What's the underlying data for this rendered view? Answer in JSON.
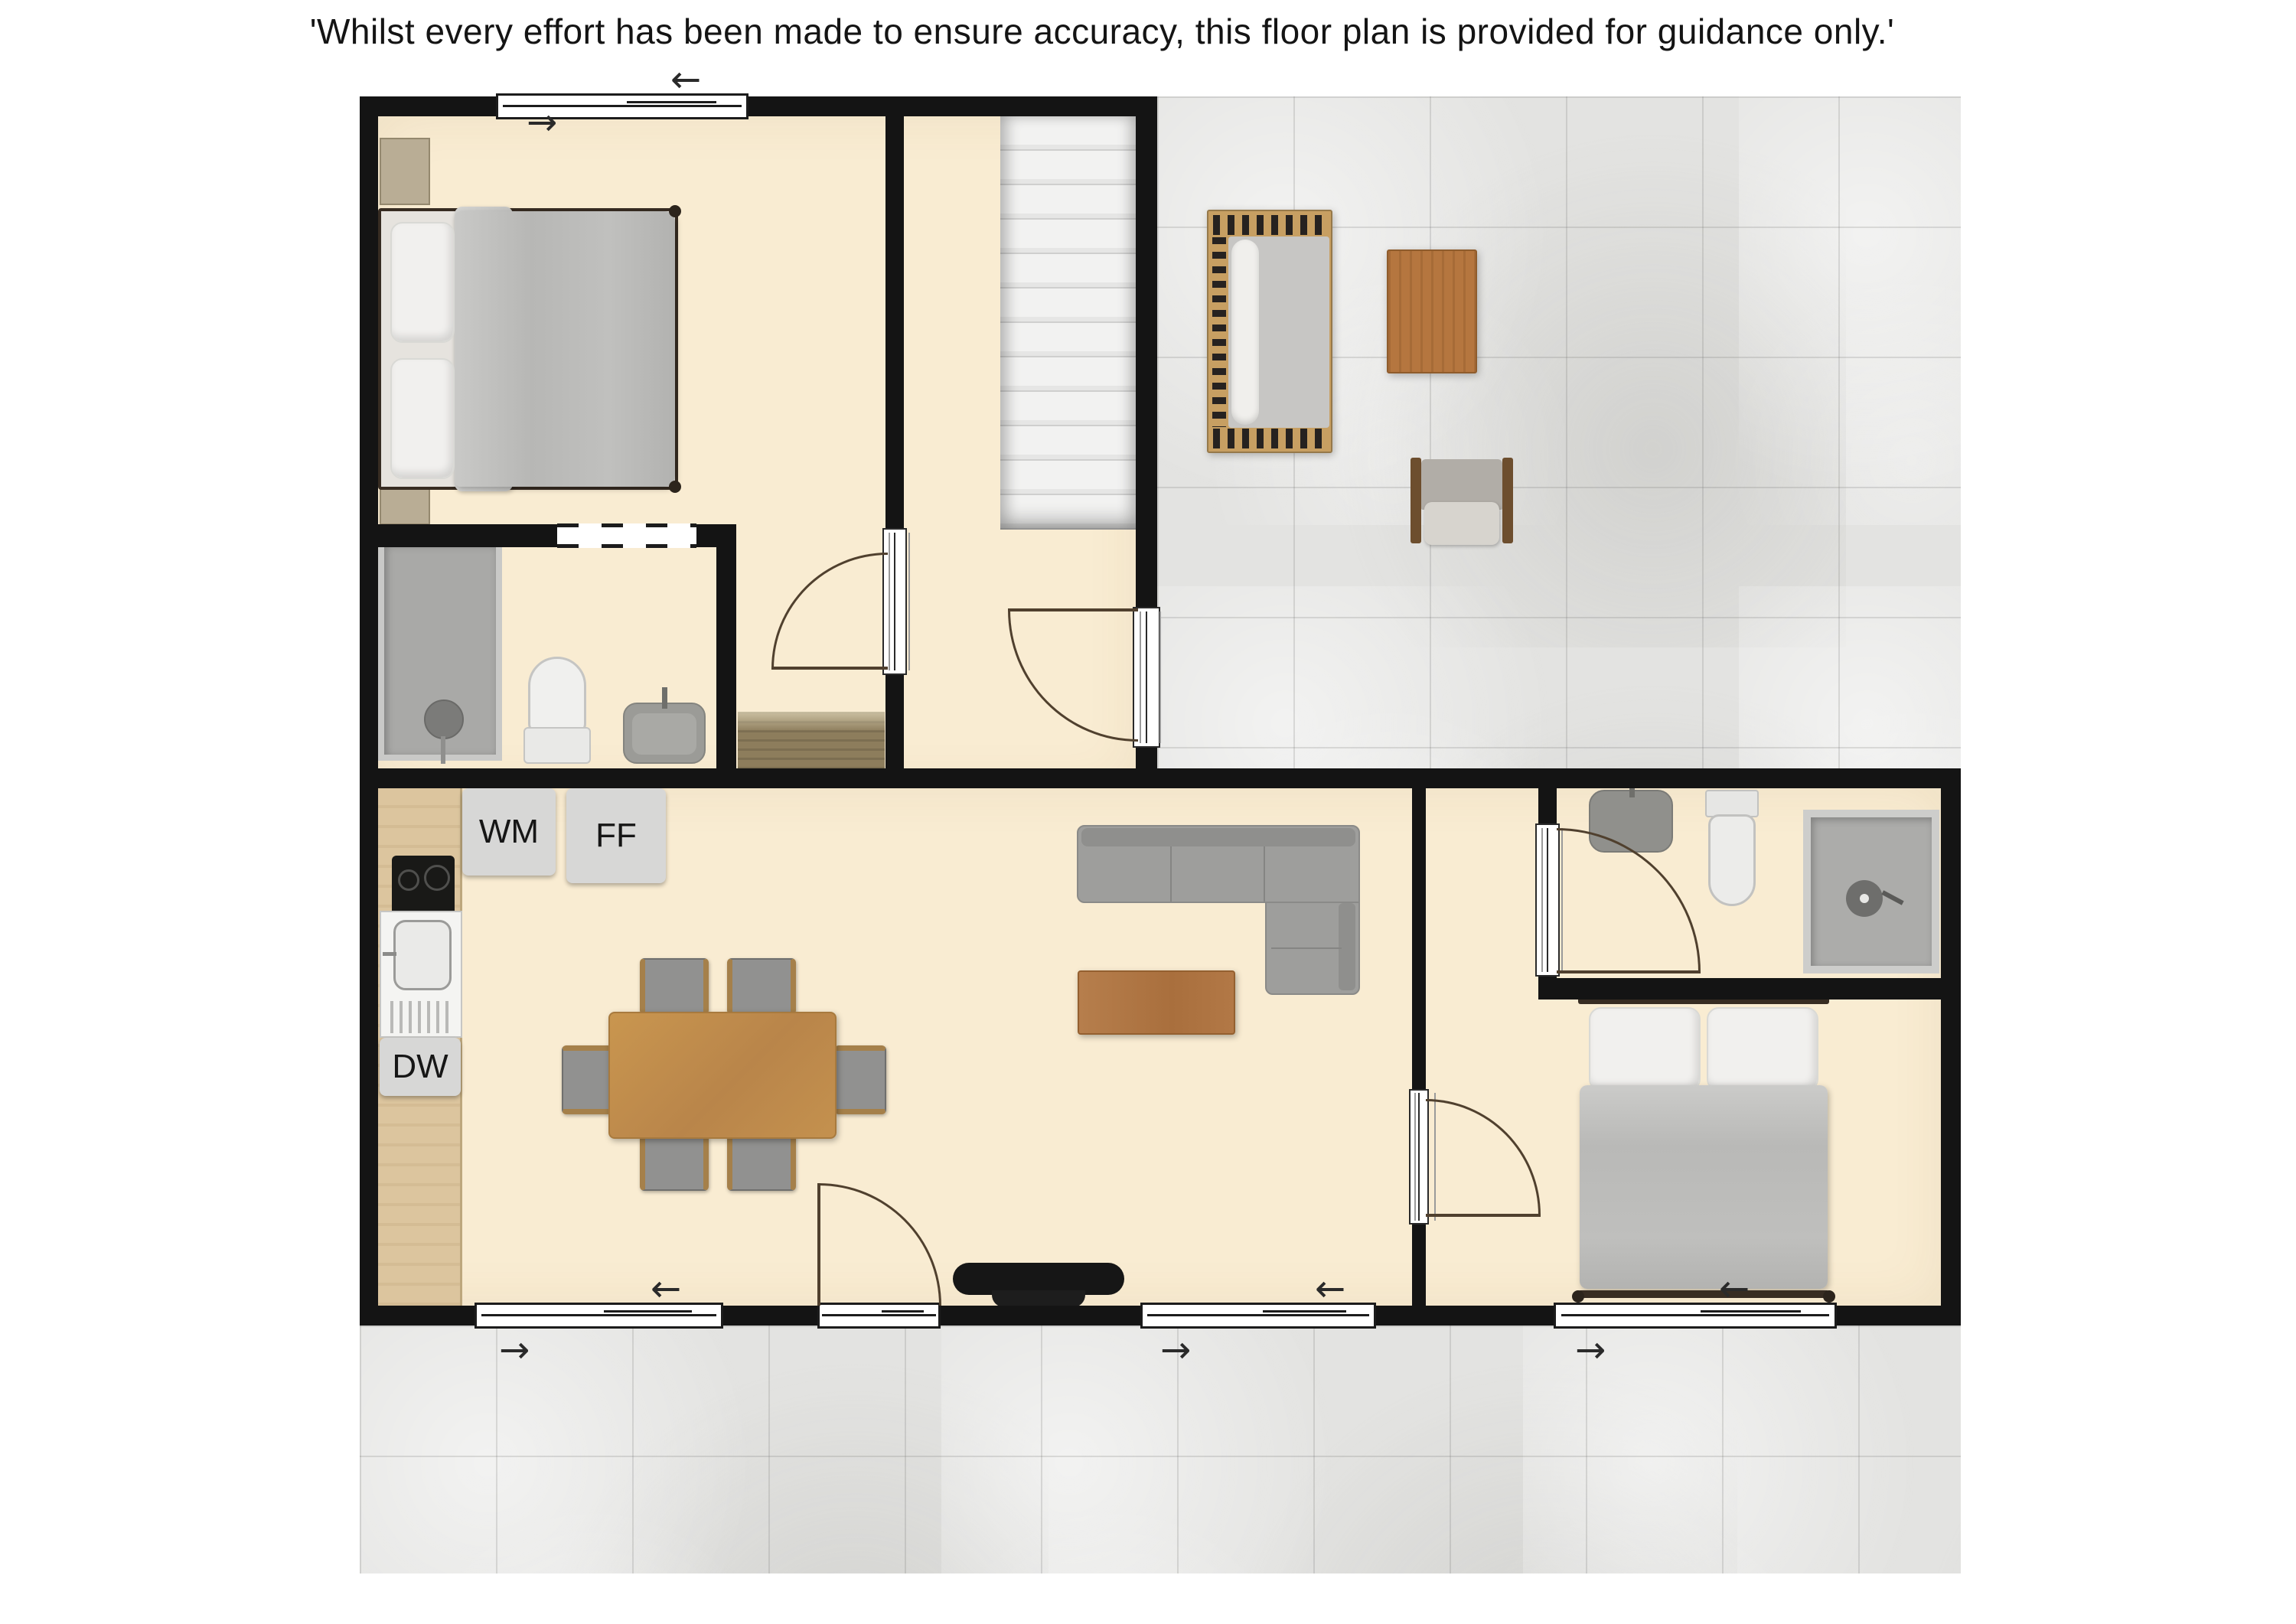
{
  "disclaimer": "'Whilst every effort has been made to ensure accuracy, this floor plan is provided for guidance only.'",
  "appliances": {
    "washing_machine": "WM",
    "fridge_freezer": "FF",
    "dishwasher": "DW"
  },
  "arrows": {
    "left": "←",
    "right": "→"
  },
  "colors": {
    "wall": "#141414",
    "floor": "#f9ecd2",
    "tile": "#e3e3e1",
    "stairs": "#efefee",
    "duvet": "#bdbdbd",
    "sofa": "#9e9e9c",
    "dining_wood": "#c18e4d",
    "coffee_table_wood": "#b07948",
    "patio_wood": "#b5763f",
    "kitchen_counter_wood": "#dcc59e",
    "appliance_gray": "#d7d7d6",
    "door_arc": "#50402e",
    "doormat_wood": "#8d7d5c"
  }
}
